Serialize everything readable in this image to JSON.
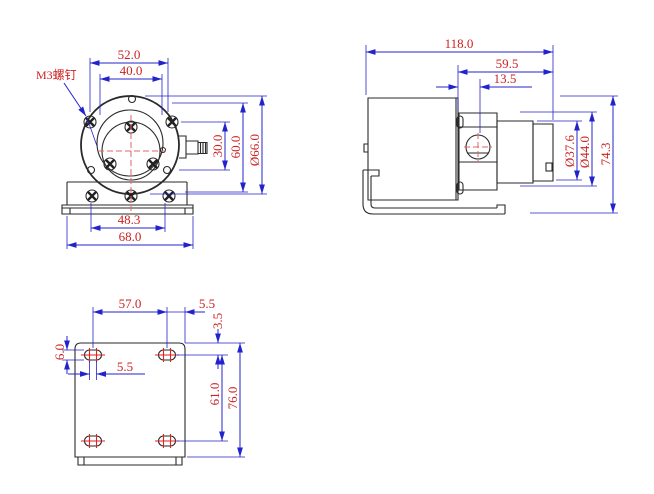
{
  "drawing": {
    "kind": "engineering-drawing",
    "views": [
      "front",
      "side",
      "bottom"
    ]
  },
  "colors": {
    "dimension_line": "#2323cc",
    "dimension_text": "#cc2222",
    "geometry": "#2a2a2a",
    "centerline": "#e06666",
    "background": "#ffffff"
  },
  "front_view": {
    "screw_note": "M3螺钉",
    "dims": {
      "top_outer": "52.0",
      "top_inner": "40.0",
      "right_inner": "30.0",
      "right_mid": "60.0",
      "right_outer": "Ø66.0",
      "bottom_inner": "48.3",
      "bottom_outer": "68.0"
    }
  },
  "side_view": {
    "dims": {
      "overall_length": "118.0",
      "head_length": "59.5",
      "port_offset": "13.5",
      "shaft_dia": "Ø37.6",
      "body_dia": "Ø44.0",
      "overall_height": "74.3"
    }
  },
  "bottom_view": {
    "dims": {
      "hole_pitch_x": "57.0",
      "right_margin": "5.5",
      "top_margin": "3.5",
      "slot_width": "6.0",
      "slot_length": "5.5",
      "hole_pitch_y": "61.0",
      "overall_depth": "76.0"
    }
  }
}
